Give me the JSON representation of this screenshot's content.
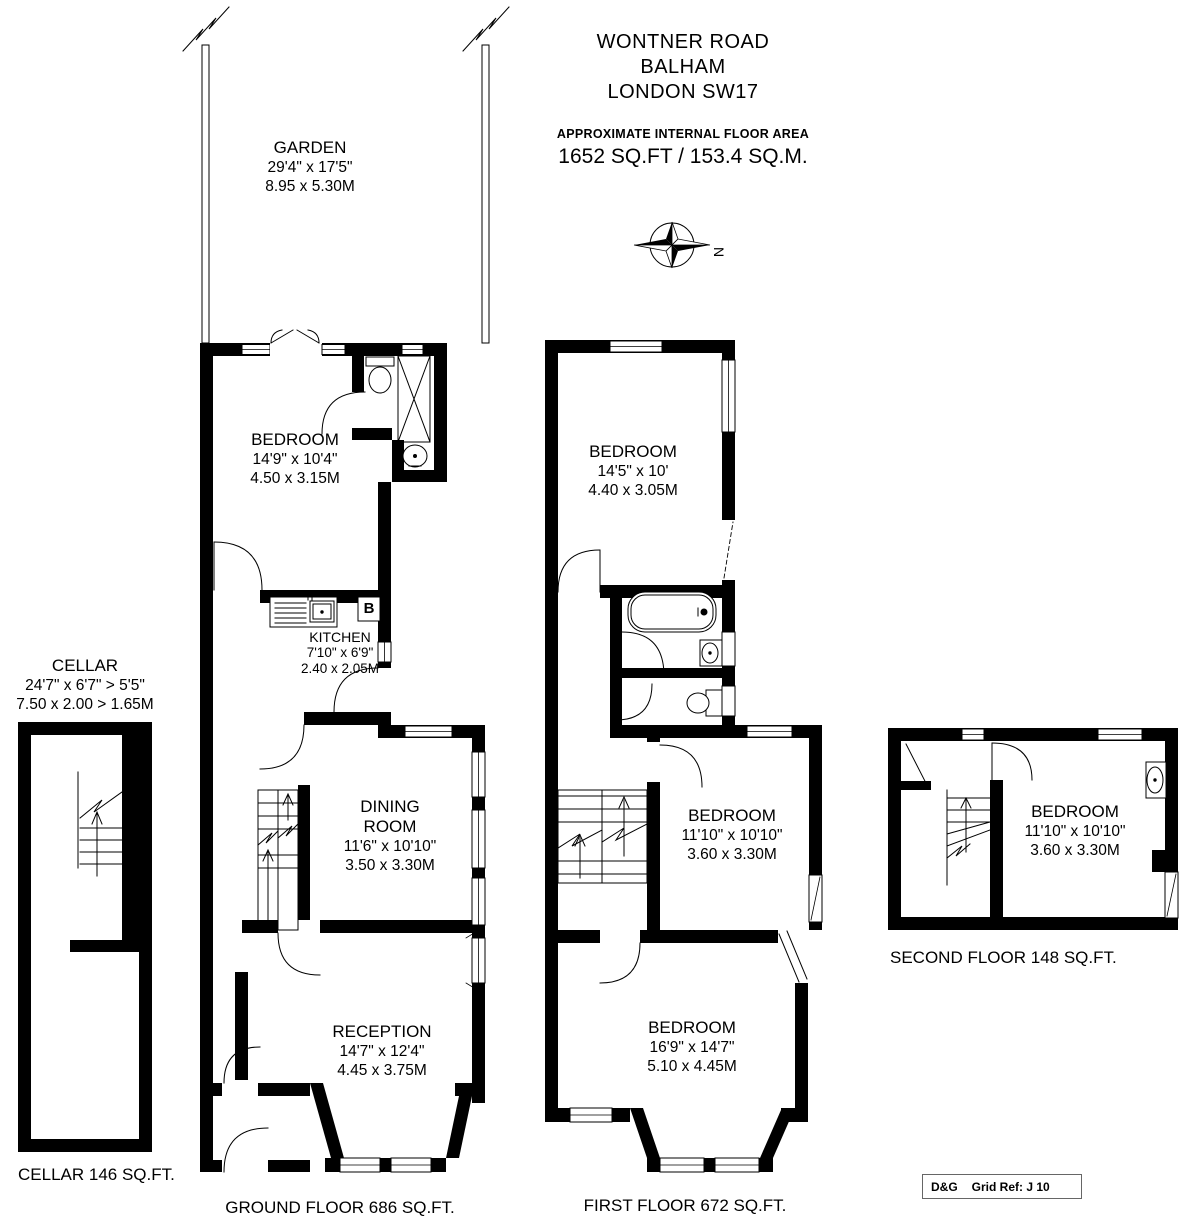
{
  "header": {
    "line1": "WONTNER ROAD",
    "line2": "BALHAM",
    "line3": "LONDON SW17",
    "area_caption": "APPROXIMATE INTERNAL FLOOR AREA",
    "area_value": "1652 SQ.FT / 153.4 SQ.M."
  },
  "compass": {
    "letter": "N"
  },
  "garden": {
    "name": "GARDEN",
    "imperial": "29'4\" x 17'5\"",
    "metric": "8.95 x 5.30M"
  },
  "cellar": {
    "name": "CELLAR",
    "imperial": "24'7\" x 6'7\" > 5'5\"",
    "metric": "7.50 x 2.00 > 1.65M",
    "floor_label": "CELLAR 146 SQ.FT."
  },
  "ground_floor": {
    "floor_label": "GROUND FLOOR 686 SQ.FT.",
    "boiler_label": "B",
    "bedroom": {
      "name": "BEDROOM",
      "imperial": "14'9\" x 10'4\"",
      "metric": "4.50 x 3.15M"
    },
    "kitchen": {
      "name": "KITCHEN",
      "imperial": "7'10\" x 6'9\"",
      "metric": "2.40 x 2.05M"
    },
    "dining": {
      "name": "DINING ROOM",
      "imperial": "11'6\" x 10'10\"",
      "metric": "3.50 x 3.30M"
    },
    "reception": {
      "name": "RECEPTION",
      "imperial": "14'7\" x 12'4\"",
      "metric": "4.45 x 3.75M"
    }
  },
  "first_floor": {
    "floor_label": "FIRST FLOOR 672 SQ.FT.",
    "bedroom_rear": {
      "name": "BEDROOM",
      "imperial": "14'5\" x 10'",
      "metric": "4.40 x 3.05M"
    },
    "bedroom_middle": {
      "name": "BEDROOM",
      "imperial": "11'10\" x 10'10\"",
      "metric": "3.60 x 3.30M"
    },
    "bedroom_front": {
      "name": "BEDROOM",
      "imperial": "16'9\" x 14'7\"",
      "metric": "5.10 x 4.45M"
    }
  },
  "second_floor": {
    "floor_label": "SECOND FLOOR 148 SQ.FT.",
    "bedroom": {
      "name": "BEDROOM",
      "imperial": "11'10\" x 10'10\"",
      "metric": "3.60 x 3.30M"
    }
  },
  "footer": {
    "brand": "D&G",
    "grid_ref": "Grid Ref: J 10"
  }
}
